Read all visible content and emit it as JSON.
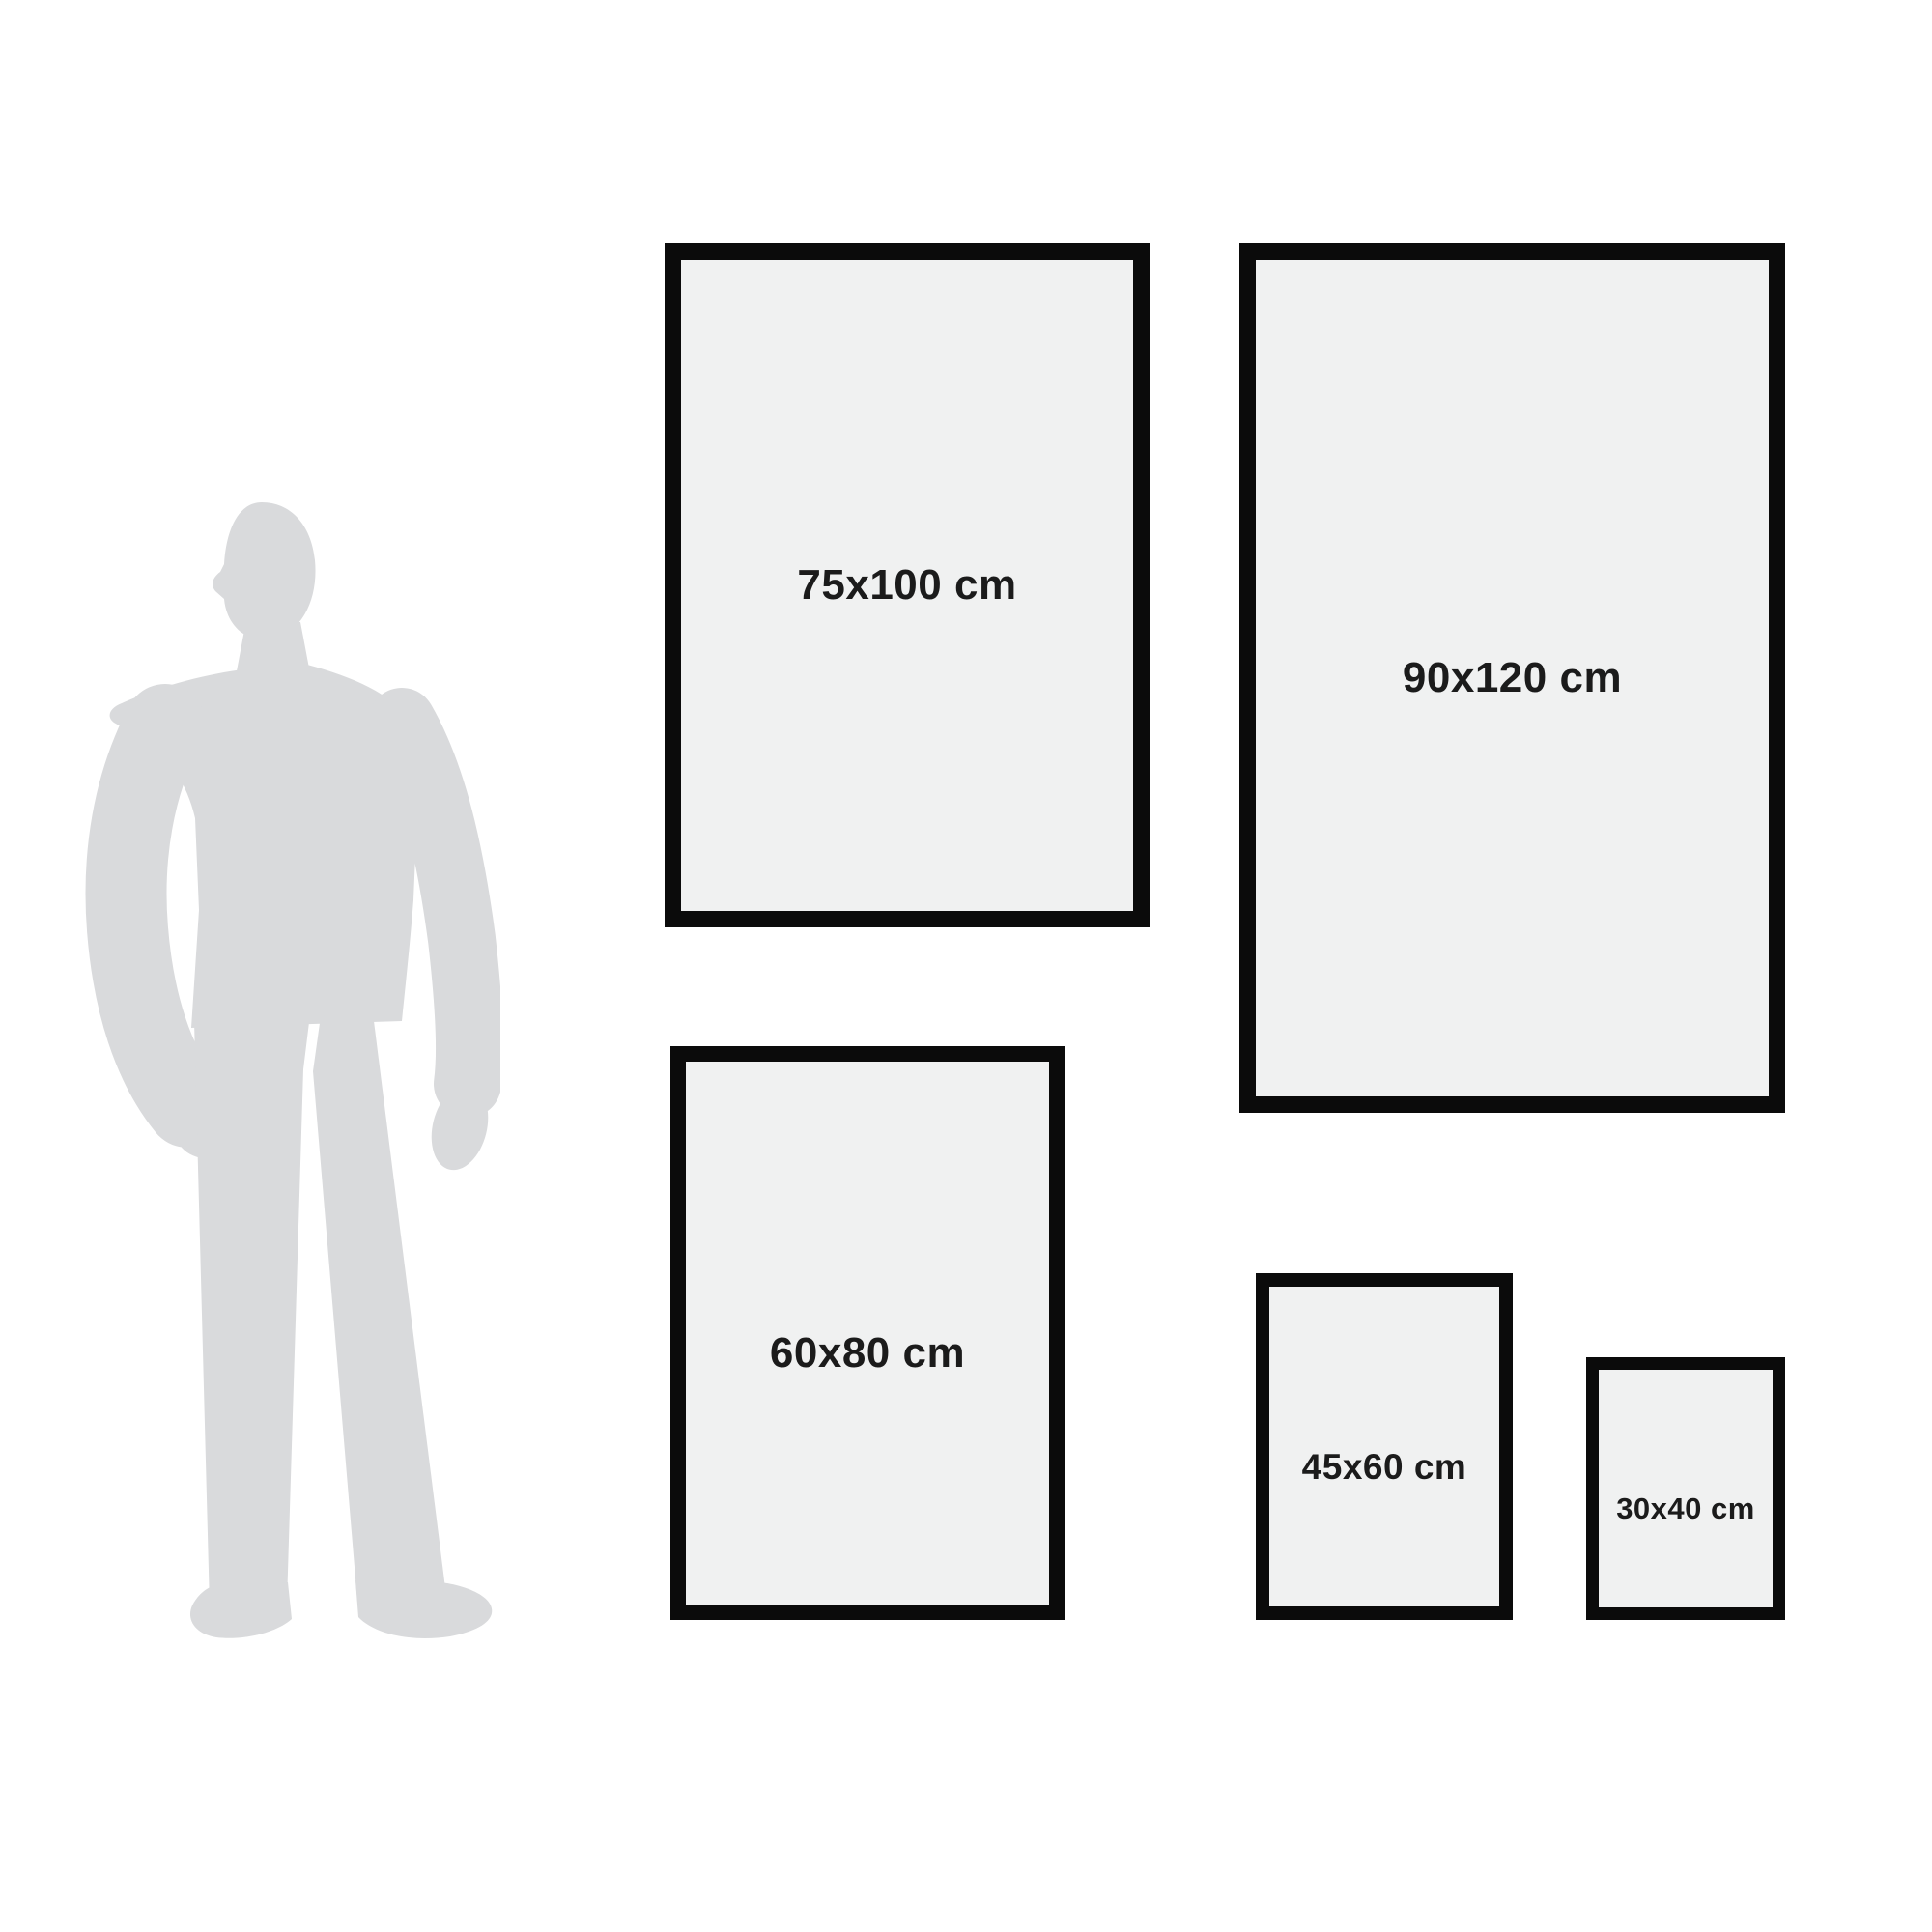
{
  "colors": {
    "background": "#ffffff",
    "frame_border": "#0b0b0b",
    "frame_fill": "#f0f1f1",
    "silhouette": "#d9dadc",
    "label_text": "#1b1b1b"
  },
  "figure": {
    "person_icon": "man-silhouette"
  },
  "frames": [
    {
      "label": "75x100 cm",
      "width_cm": 75,
      "height_cm": 100
    },
    {
      "label": "90x120 cm",
      "width_cm": 90,
      "height_cm": 120
    },
    {
      "label": "60x80 cm",
      "width_cm": 60,
      "height_cm": 80
    },
    {
      "label": "45x60 cm",
      "width_cm": 45,
      "height_cm": 60
    },
    {
      "label": "30x40 cm",
      "width_cm": 30,
      "height_cm": 40
    }
  ]
}
